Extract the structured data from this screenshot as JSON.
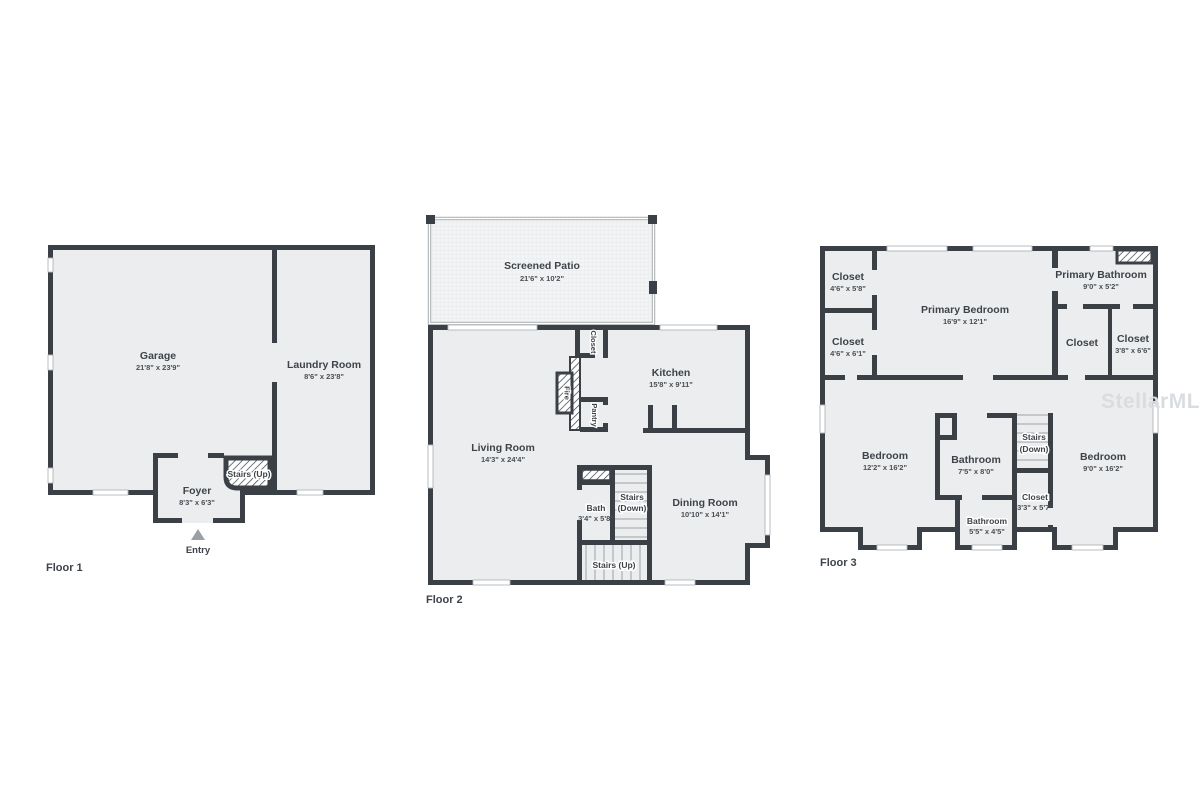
{
  "watermark": "StellarMLS",
  "colors": {
    "wall": "#3b4046",
    "room_fill": "#ebedee",
    "label_text": "#3e4349",
    "watermark": "#dadde0"
  },
  "floor1": {
    "label": "Floor 1",
    "garage_name": "Garage",
    "garage_dims": "21'8\" x 23'9\"",
    "laundry_name": "Laundry Room",
    "laundry_dims": "8'6\" x 23'8\"",
    "foyer_name": "Foyer",
    "foyer_dims": "8'3\" x 6'3\"",
    "stairs_up": "Stairs (Up)",
    "entry": "Entry"
  },
  "floor2": {
    "label": "Floor 2",
    "patio_name": "Screened Patio",
    "patio_dims": "21'6\" x 10'2\"",
    "living_name": "Living Room",
    "living_dims": "14'3\" x 24'4\"",
    "kitchen_name": "Kitchen",
    "kitchen_dims": "15'8\" x 9'11\"",
    "dining_name": "Dining Room",
    "dining_dims": "10'10\" x 14'1\"",
    "closet": "Closet",
    "fire": "Fire",
    "pantry": "Pantry",
    "bath_name": "Bath",
    "bath_dims": "3'4\" x 5'8\"",
    "stairs_down_line1": "Stairs",
    "stairs_down_line2": "(Down)",
    "stairs_up": "Stairs (Up)"
  },
  "floor3": {
    "label": "Floor 3",
    "closet_tl_name": "Closet",
    "closet_tl_dims": "4'6\" x 5'8\"",
    "closet_ml_name": "Closet",
    "closet_ml_dims": "4'6\" x 6'1\"",
    "primary_bedroom_name": "Primary Bedroom",
    "primary_bedroom_dims": "16'9\" x 12'1\"",
    "primary_bathroom_name": "Primary Bathroom",
    "primary_bathroom_dims": "9'0\" x 5'2\"",
    "closet_mid": "Closet",
    "closet_r_name": "Closet",
    "closet_r_dims": "3'8\" x 6'6\"",
    "bedroom_l_name": "Bedroom",
    "bedroom_l_dims": "12'2\" x 16'2\"",
    "bathroom_c_name": "Bathroom",
    "bathroom_c_dims": "7'5\" x 8'0\"",
    "stairs_line1": "Stairs",
    "stairs_line2": "(Down)",
    "bedroom_r_name": "Bedroom",
    "bedroom_r_dims": "9'0\" x 16'2\"",
    "closet_s_name": "Closet",
    "closet_s_dims": "3'3\" x 5'7\"",
    "bathroom_b_name": "Bathroom",
    "bathroom_b_dims": "5'5\" x 4'5\""
  }
}
